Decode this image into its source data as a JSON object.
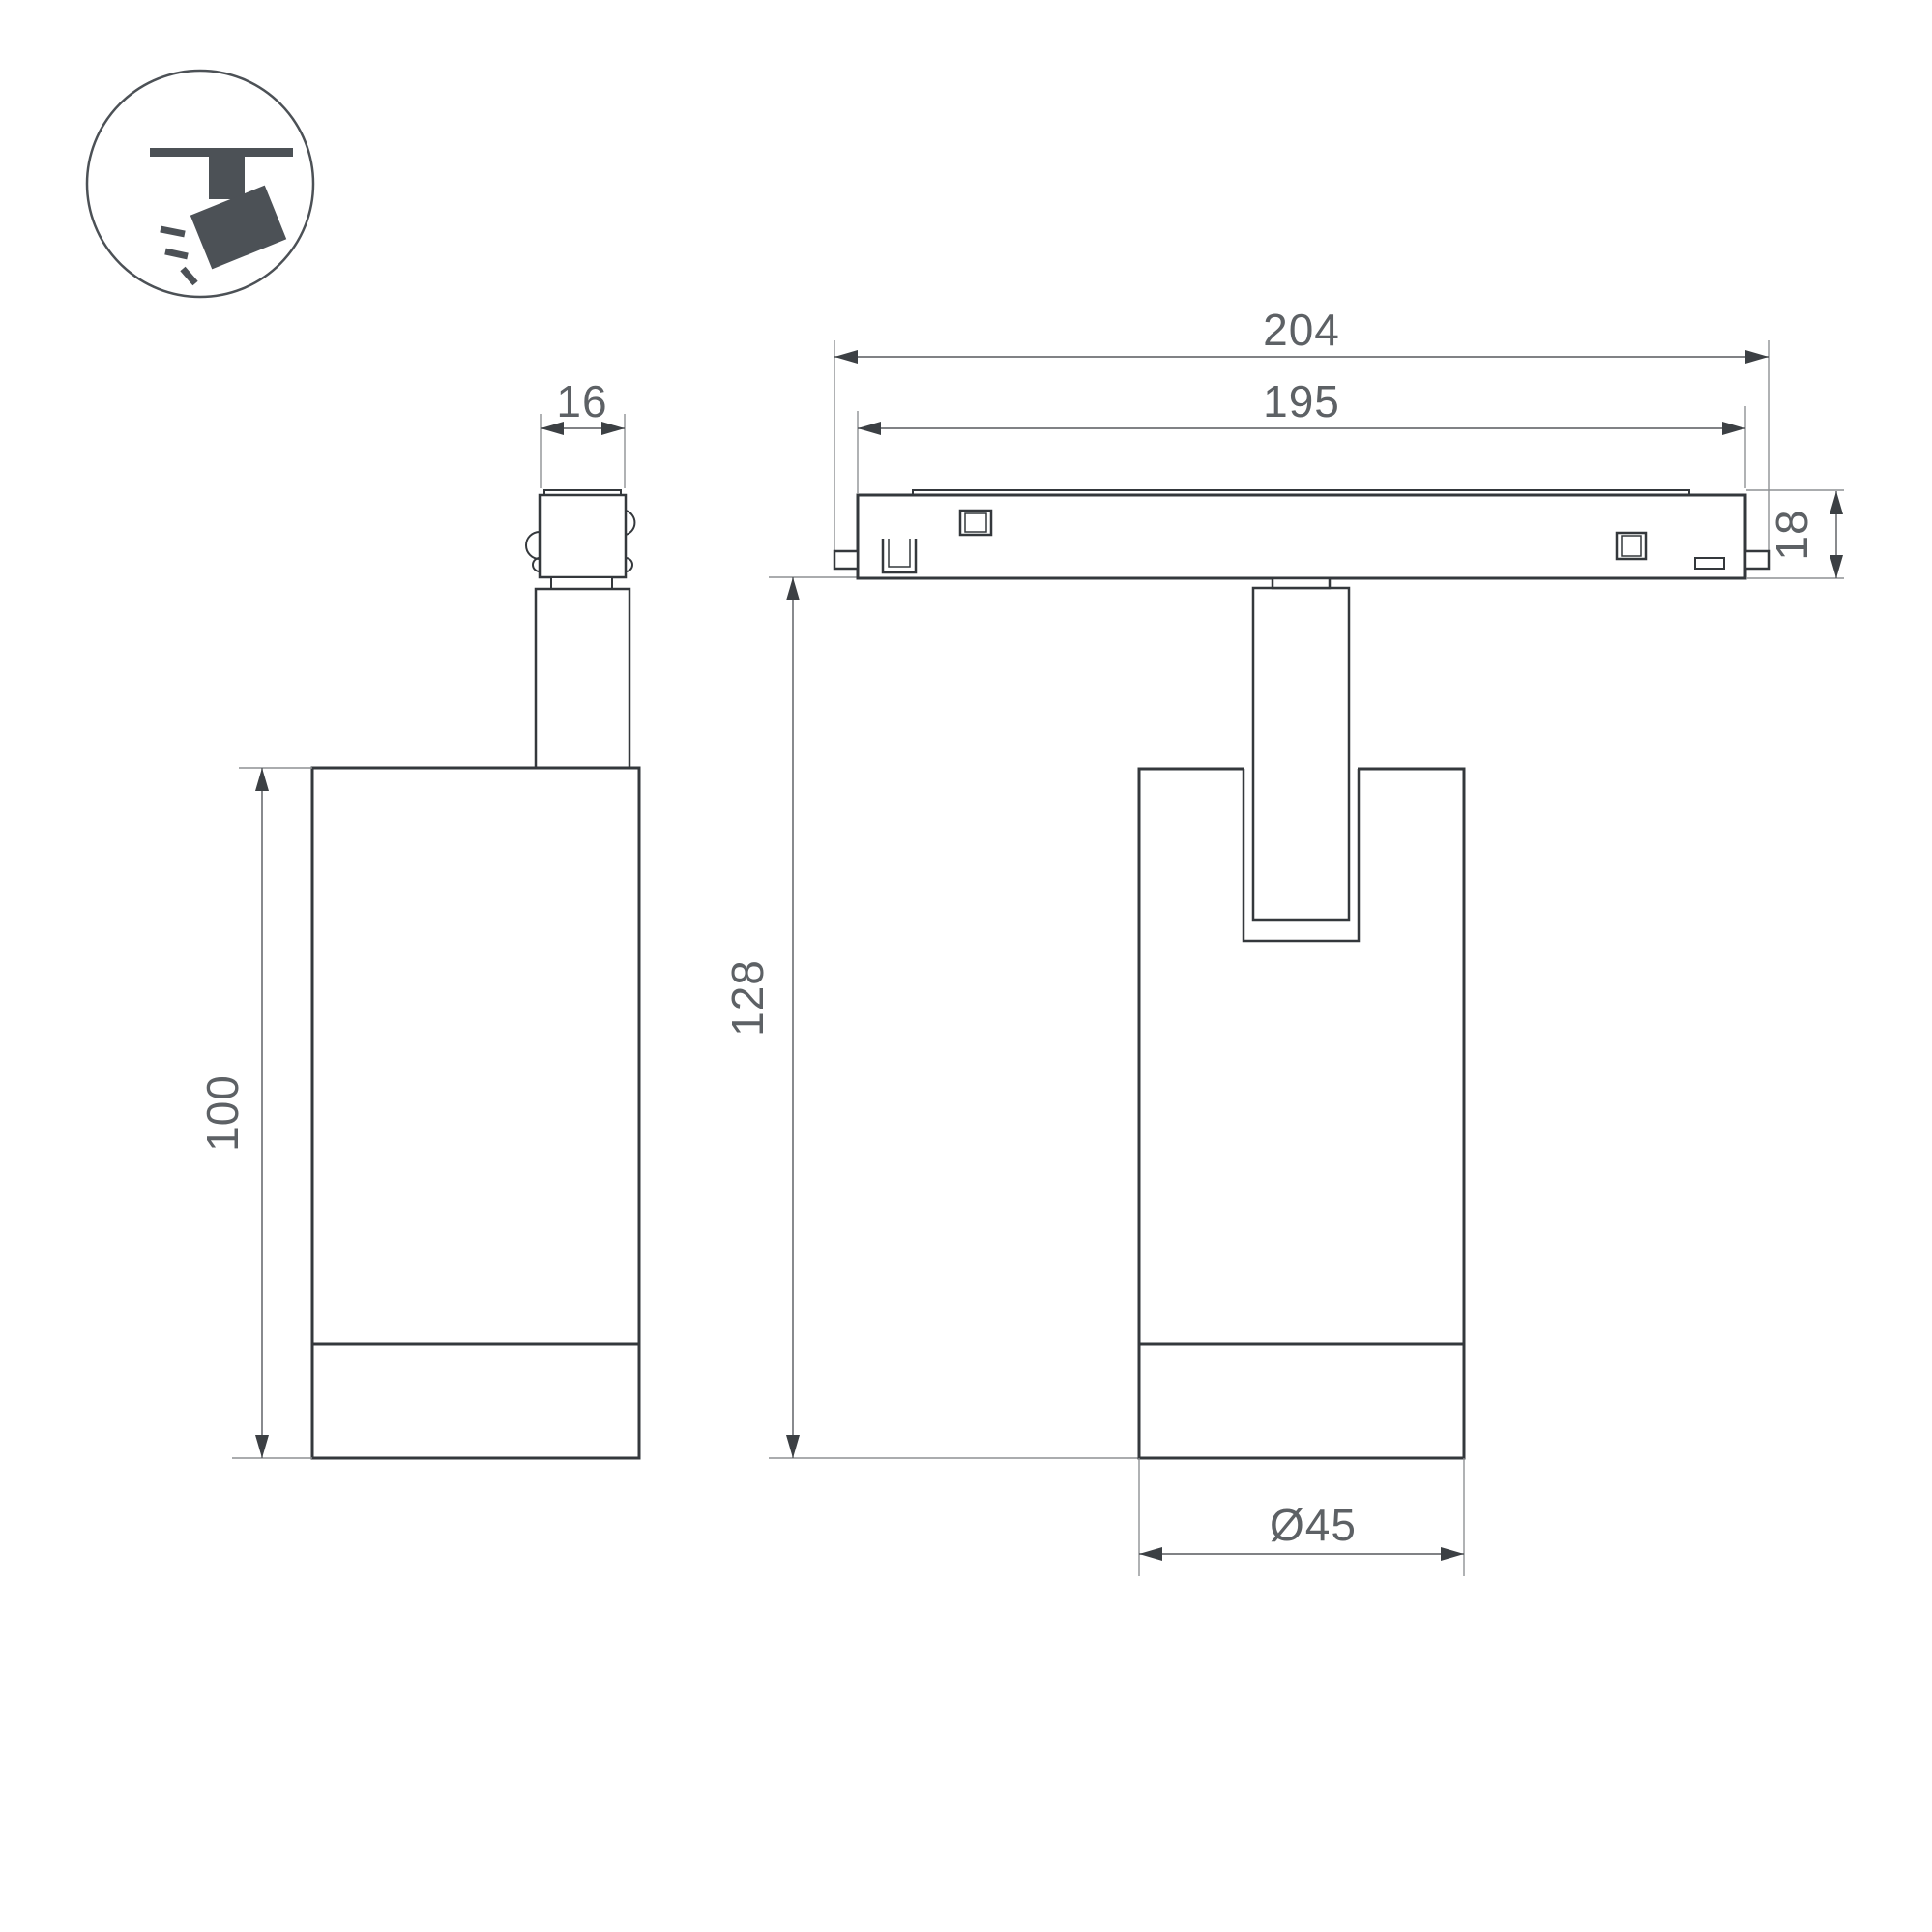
{
  "drawing": {
    "type": "technical-dimension-drawing",
    "subject": "magnetic track spotlight",
    "background_color": "#ffffff",
    "object_line_color": "#34383c",
    "dimension_line_color": "#56595d",
    "extension_line_color": "#8e9194",
    "text_color": "#5d6165",
    "icon_color": "#4c5156"
  },
  "icon": {
    "name": "track-spotlight-pictogram",
    "description": "spotlight hanging from track emitting light rays"
  },
  "dims": {
    "connector_width": "16",
    "body_height": "100",
    "overall_length": "204",
    "track_length": "195",
    "track_height": "18",
    "total_height": "128",
    "diameter": "Ø45"
  }
}
